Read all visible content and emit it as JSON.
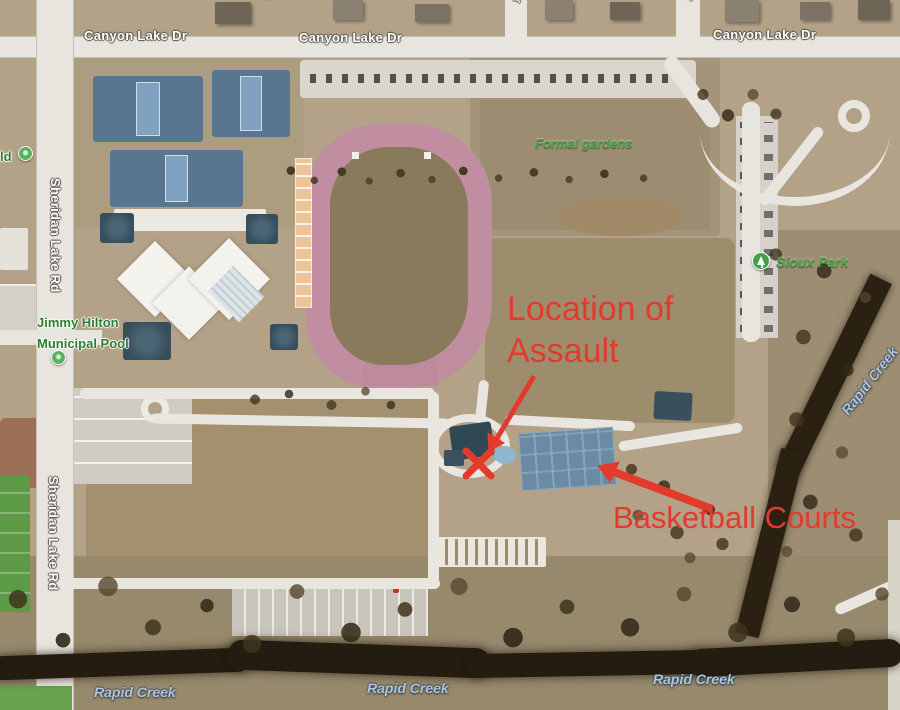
{
  "map_title": "Sioux Park aerial map with assault location annotations",
  "colors": {
    "annotation_red": "#e23b2e",
    "road_label_white": "#ffffff",
    "poi_label_green": "#2e7d32",
    "park_label_green": "#52a24a",
    "water_label_blue": "#a9c6e6"
  },
  "road_labels": {
    "canyon_lake_dr_1": "Canyon Lake Dr",
    "canyon_lake_dr_2": "Canyon Lake Dr",
    "canyon_lake_dr_3": "Canyon Lake Dr",
    "sheridan_lake_rd_1": "Sheridan Lake Rd",
    "sheridan_lake_rd_2": "Sheridan Lake Rd",
    "dr_partial_1": "Dr",
    "dr_partial_2": "Dr",
    "street_partial_top": "u"
  },
  "poi_labels": {
    "pool_line1": "Jimmy Hilton",
    "pool_line2": "Municipal Pool",
    "field_partial": "ld",
    "formal_gardens": "Formal gardens",
    "sioux_park": "Sioux Park"
  },
  "water_labels": {
    "rapid_creek_1": "Rapid Creek",
    "rapid_creek_2": "Rapid Creek",
    "rapid_creek_3": "Rapid Creek",
    "rapid_creek_diagonal": "Rapid Creek"
  },
  "annotations": {
    "location_line_1": "Location of",
    "location_line_2": "Assault",
    "basketball_label": "Basketball Courts",
    "x_marker_icon": "x-cross",
    "arrow_1_icon": "arrow-to-assault-location",
    "arrow_2_icon": "arrow-to-basketball-courts"
  }
}
